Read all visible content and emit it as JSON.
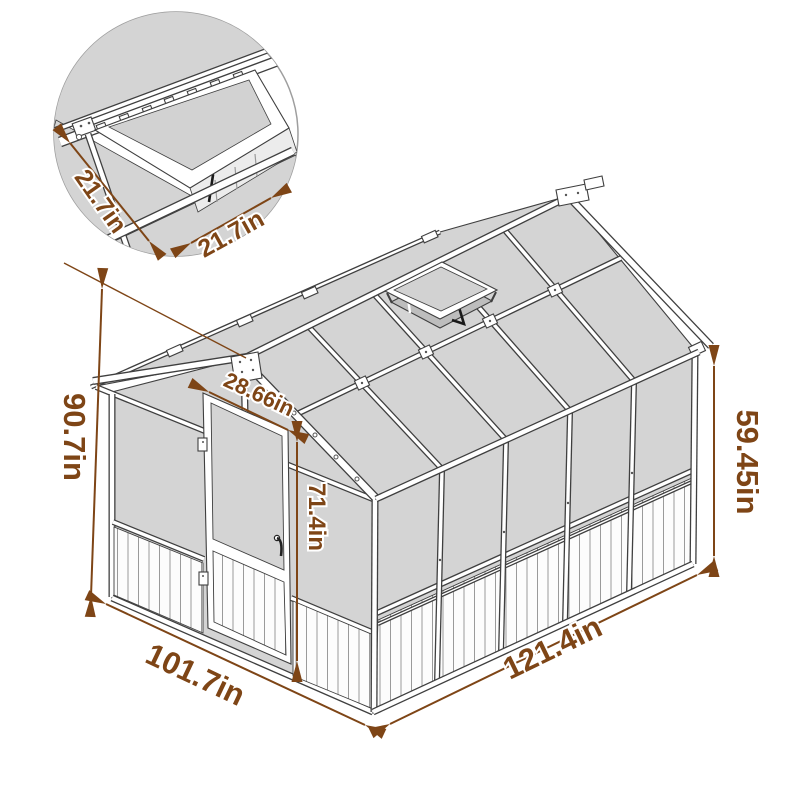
{
  "diagram": {
    "type": "greenhouse-dimension-diagram",
    "labels": {
      "total_height": "90.7in",
      "front_width": "101.7in",
      "side_length": "121.4in",
      "side_wall_height": "59.45in",
      "door_height": "71.4in",
      "door_width": "28.66in",
      "vent_side_a": "21.7in",
      "vent_side_b": "21.7in"
    },
    "colors": {
      "dimension_text": "#7e4516",
      "panel_gray": "#d4d4d4",
      "outline": "#3f3f3f"
    }
  }
}
